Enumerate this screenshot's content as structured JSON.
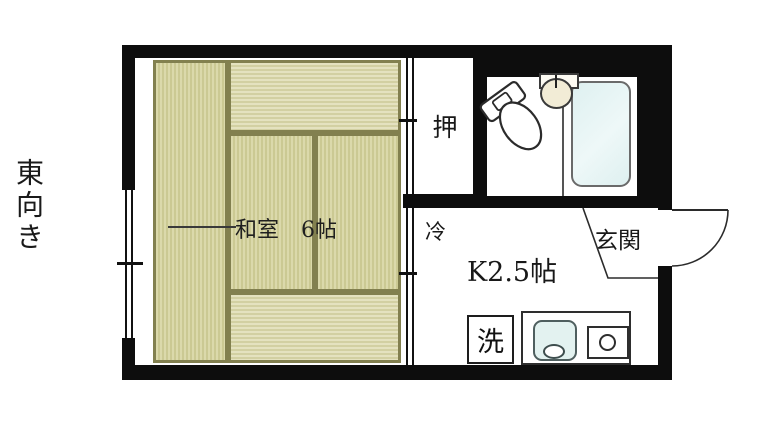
{
  "orientation": {
    "label": "東向き"
  },
  "floorplan": {
    "rooms": {
      "washitsu": {
        "label": "和室　6帖"
      },
      "closet": {
        "label": "押"
      },
      "kitchen": {
        "label": "K2.5帖"
      },
      "fridge": {
        "label": "冷"
      },
      "entrance": {
        "label": "玄関"
      },
      "laundry": {
        "label": "洗"
      }
    },
    "icons": [
      "toilet-icon",
      "wash-basin-icon",
      "bathtub-icon",
      "washing-machine-box",
      "kitchen-sink-icon",
      "stove-icon",
      "entrance-door-arc",
      "window-symbol",
      "sliding-door-symbol"
    ],
    "colors": {
      "wall": "#0d0d0d",
      "tatami_light": "#dbd9ab",
      "tatami_grain": "#cbc993",
      "tatami_border": "#82804f",
      "bathtub_fill": "#def0f0",
      "basin_fill": "#f2ecd6",
      "kitchen_sink_fill": "#e3f2f0",
      "line": "#2b2b2b"
    }
  }
}
